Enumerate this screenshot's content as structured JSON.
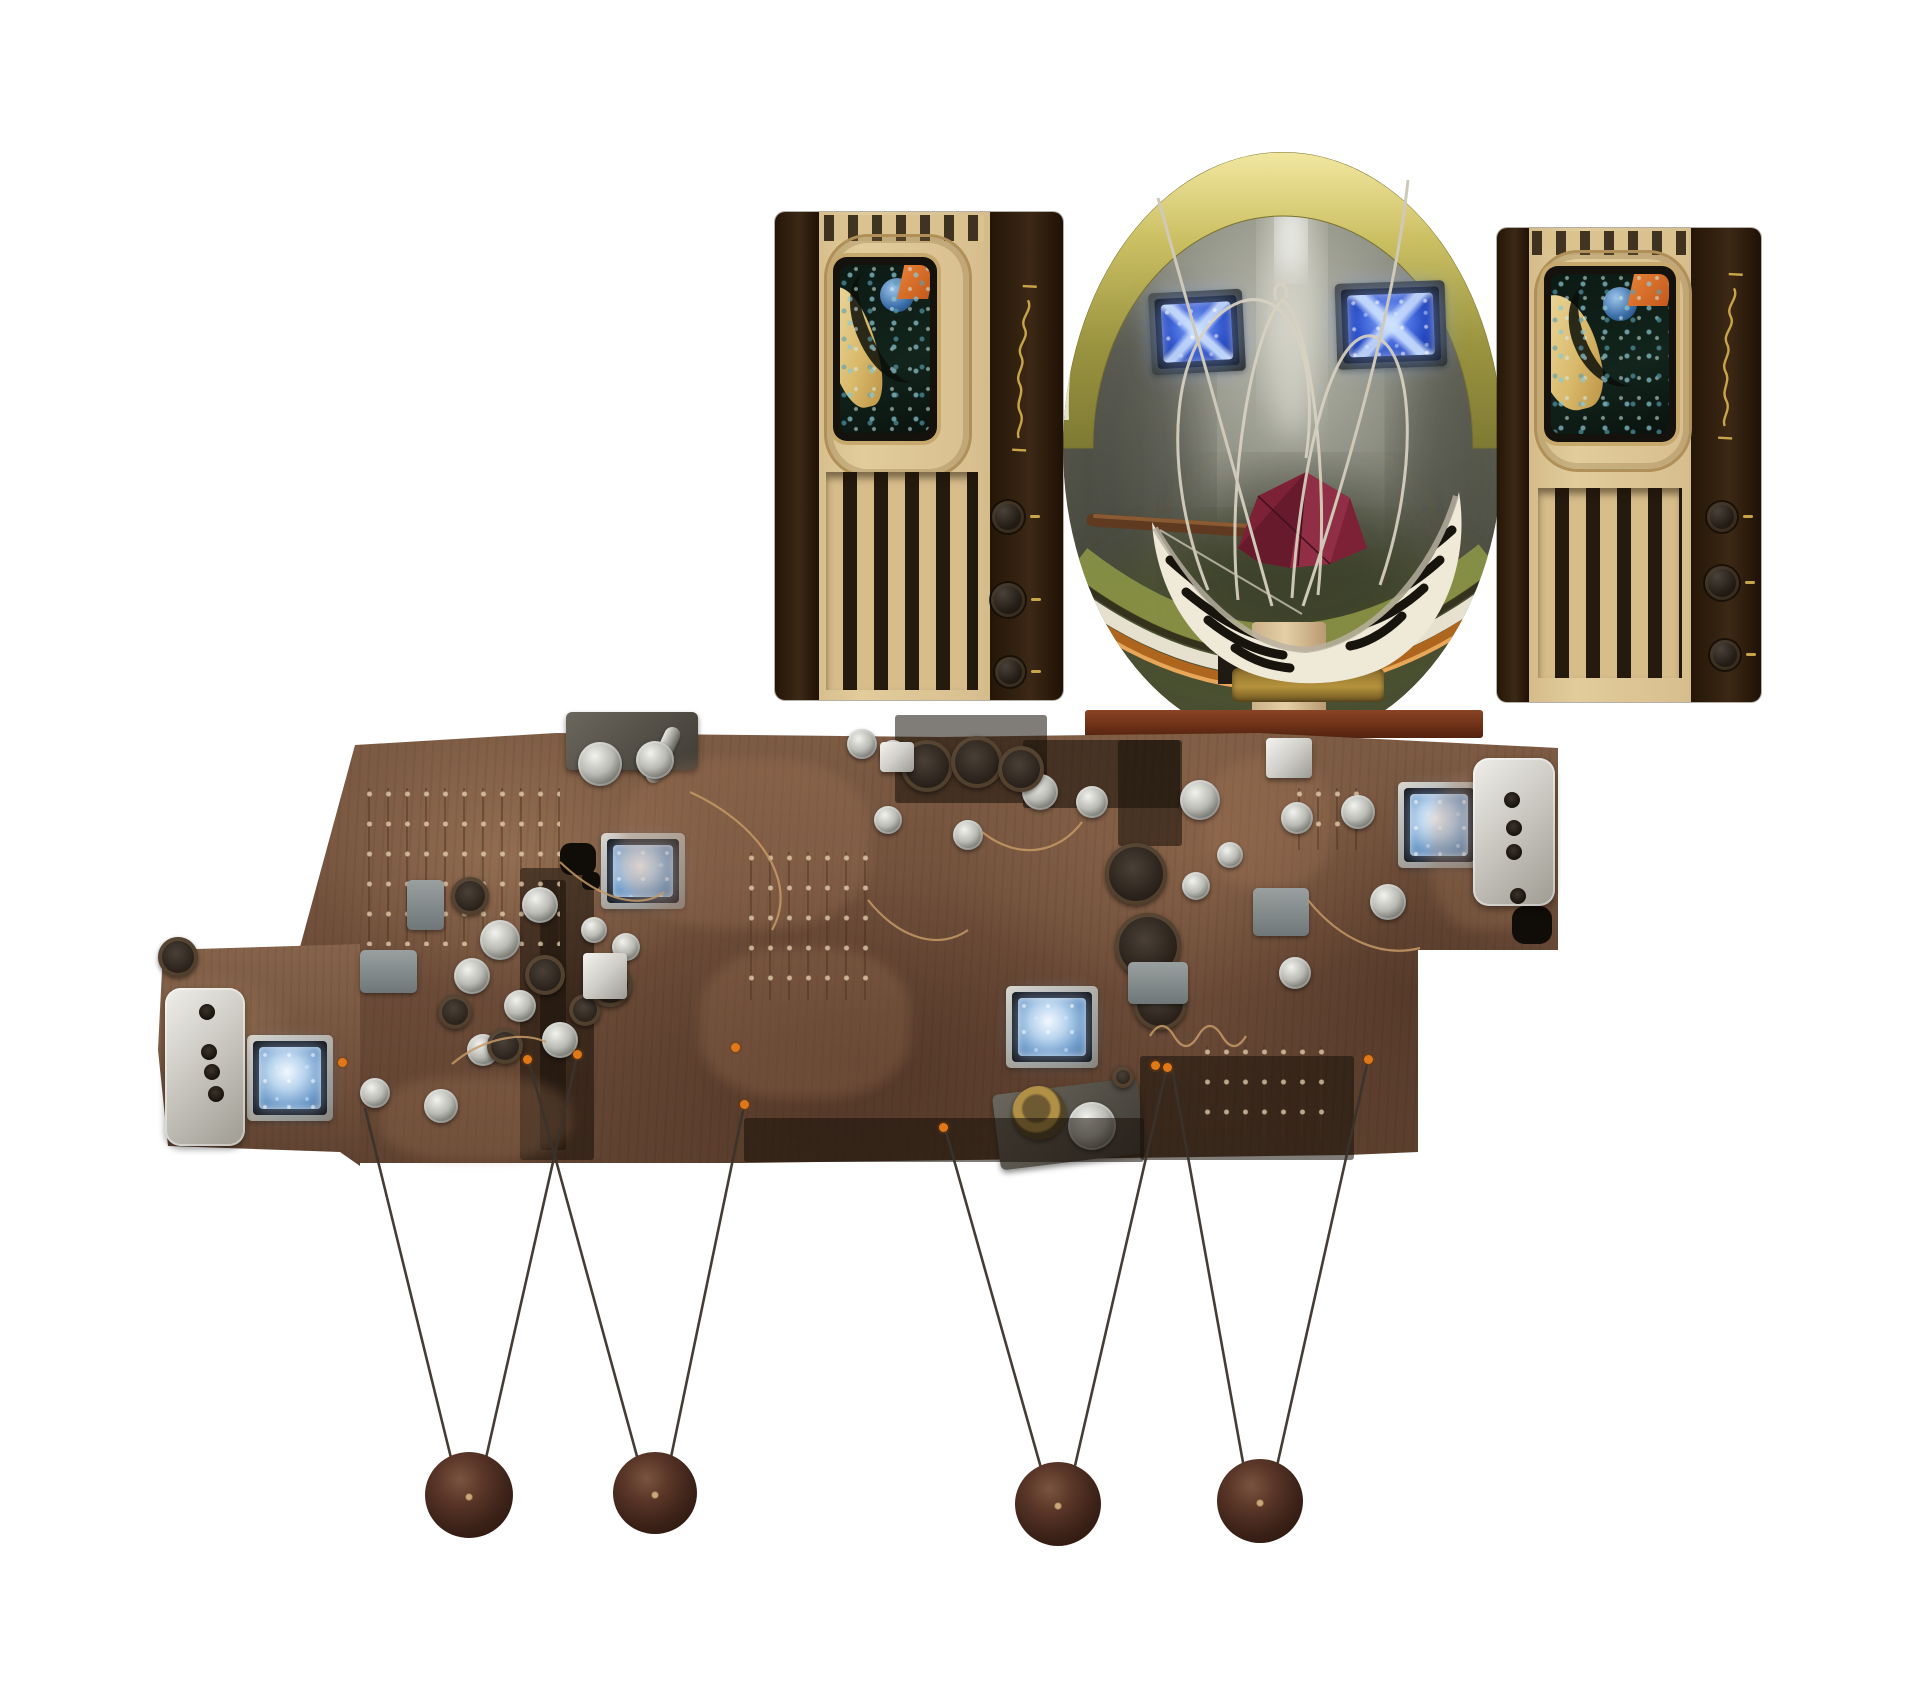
{
  "scene": {
    "title": "Photo collage of a vintage television video-art installation",
    "background": "#ffffff",
    "elements": [
      "two art-deco wooden televisions with small colorful CRT screens, vertical slats and side knobs",
      "large round metallic dish display with golden rim, two glowing blue mini screens, wire loops, a black-and-white striped bowl holding a dark red folded ornament on a pedestal and wooden base plank",
      "wide brown vintage circuit board panel with vacuum tubes, silver boxes and four glowing mini screens",
      "four thin wires hanging in V shapes from the board, each pair holding a dark wooden ball"
    ]
  },
  "palette": {
    "background": "#ffffff",
    "wood_board": "#6b4b38",
    "tv_cabinet_cream": "#d8bf8f",
    "tv_panel_dark": "#2e1d10",
    "dish_rim_gold": "#cbbf63",
    "dish_interior_grey": "#6b6d60",
    "glow_blue": "#4a6fe0",
    "bowl_white": "#efe9d8",
    "ornament_maroon": "#7c2136",
    "copper_band": "#b4671f",
    "anchor_orange": "#e07818",
    "ball_brown": "#3c2218",
    "script_gold": "#c9a54a"
  },
  "dish": {
    "screens": [
      {
        "x": 1150,
        "y": 291,
        "w": 94,
        "h": 82,
        "tilt": -3,
        "framed": false,
        "tone": "blue",
        "z": 2
      },
      {
        "x": 1336,
        "y": 282,
        "w": 110,
        "h": 86,
        "tilt": -2,
        "framed": false,
        "tone": "blue",
        "z": 2
      }
    ],
    "bowl_stripes_per_side": 4,
    "wire_loops": 3
  },
  "tvs": {
    "count": 2,
    "knobs": [
      [
        1008,
        517,
        16
      ],
      [
        1008,
        600,
        17
      ],
      [
        1010,
        672,
        15
      ],
      [
        1722,
        517,
        15
      ],
      [
        1722,
        583,
        17
      ],
      [
        1725,
        655,
        15
      ]
    ],
    "slats_per_tv": 5
  },
  "board": {
    "mini_screens": [
      {
        "x": 247,
        "y": 1035,
        "w": 86,
        "h": 86,
        "framed": true,
        "tone": "pale",
        "z": 4
      },
      {
        "x": 601,
        "y": 833,
        "w": 84,
        "h": 76,
        "framed": true,
        "tone": "pale",
        "z": 4
      },
      {
        "x": 1006,
        "y": 986,
        "w": 92,
        "h": 82,
        "framed": true,
        "tone": "pale",
        "z": 4
      },
      {
        "x": 1398,
        "y": 782,
        "w": 82,
        "h": 86,
        "framed": true,
        "tone": "pale",
        "z": 4
      }
    ],
    "silver_boxes": [
      {
        "x": 165,
        "y": 988,
        "w": 80,
        "h": 158,
        "holes": [
          [
            207,
            1012
          ],
          [
            209,
            1052
          ],
          [
            212,
            1072
          ],
          [
            216,
            1094
          ]
        ]
      },
      {
        "x": 1473,
        "y": 758,
        "w": 82,
        "h": 148,
        "holes": [
          [
            1512,
            800
          ],
          [
            1514,
            828
          ],
          [
            1514,
            852
          ],
          [
            1518,
            896
          ]
        ]
      }
    ],
    "tubes_silver": [
      [
        375,
        1093,
        15
      ],
      [
        441,
        1106,
        17
      ],
      [
        600,
        764,
        22
      ],
      [
        655,
        760,
        19
      ],
      [
        540,
        905,
        18
      ],
      [
        500,
        940,
        20
      ],
      [
        472,
        976,
        18
      ],
      [
        520,
        1006,
        16
      ],
      [
        560,
        1040,
        18
      ],
      [
        483,
        1050,
        16
      ],
      [
        594,
        930,
        13
      ],
      [
        626,
        947,
        14
      ],
      [
        888,
        820,
        14
      ],
      [
        862,
        744,
        15
      ],
      [
        893,
        753,
        13
      ],
      [
        968,
        835,
        15
      ],
      [
        1040,
        792,
        18
      ],
      [
        1092,
        802,
        16
      ],
      [
        1200,
        800,
        20
      ],
      [
        1297,
        818,
        16
      ],
      [
        1196,
        886,
        14
      ],
      [
        1295,
        973,
        16
      ],
      [
        1358,
        812,
        17
      ],
      [
        1388,
        902,
        18
      ],
      [
        1230,
        855,
        13
      ]
    ],
    "tubes_dark": [
      [
        927,
        766,
        26
      ],
      [
        977,
        762,
        26
      ],
      [
        1021,
        769,
        23
      ],
      [
        1136,
        874,
        31
      ],
      [
        1148,
        946,
        33
      ],
      [
        1160,
        1003,
        27
      ],
      [
        470,
        896,
        19
      ],
      [
        455,
        1012,
        17
      ],
      [
        505,
        1046,
        18
      ],
      [
        585,
        1010,
        16
      ],
      [
        545,
        975,
        20
      ],
      [
        610,
        985,
        22
      ],
      [
        178,
        957,
        20
      ]
    ],
    "cubes": [
      [
        583,
        953,
        44,
        46
      ],
      [
        1266,
        738,
        46,
        40
      ],
      [
        880,
        742,
        34,
        30
      ]
    ],
    "grey_blocks": [
      [
        407,
        880,
        37,
        50
      ],
      [
        360,
        950,
        57,
        43
      ],
      [
        1253,
        888,
        56,
        48
      ],
      [
        1128,
        962,
        60,
        42
      ]
    ],
    "black_squares": [
      [
        560,
        843,
        36,
        32
      ],
      [
        582,
        872,
        18,
        18
      ],
      [
        1512,
        906,
        40,
        38
      ]
    ],
    "pin_zones": [
      [
        360,
        788,
        200,
        158
      ],
      [
        742,
        852,
        128,
        148
      ],
      [
        1290,
        788,
        70,
        62
      ],
      [
        1198,
        1046,
        138,
        92
      ]
    ],
    "dark_zones": [
      [
        1023,
        740,
        157,
        68
      ],
      [
        1118,
        740,
        64,
        106
      ],
      [
        520,
        868,
        74,
        292
      ],
      [
        540,
        880,
        26,
        270
      ],
      [
        895,
        715,
        152,
        88
      ],
      [
        1140,
        1056,
        214,
        104
      ],
      [
        744,
        1118,
        400,
        44
      ]
    ],
    "light_zones": [
      [
        620,
        758,
        250,
        170
      ],
      [
        700,
        948,
        210,
        150
      ],
      [
        1205,
        758,
        125,
        130
      ],
      [
        380,
        1076,
        190,
        84
      ],
      [
        1430,
        770,
        120,
        160
      ]
    ],
    "anchor_dots": [
      [
        342,
        1062
      ],
      [
        527,
        1059
      ],
      [
        577,
        1054
      ],
      [
        735,
        1047
      ],
      [
        744,
        1104
      ],
      [
        943,
        1127
      ],
      [
        1155,
        1065
      ],
      [
        1167,
        1067
      ],
      [
        1368,
        1059
      ]
    ]
  },
  "pendulums": {
    "wires": [
      [
        365,
        1108,
        452,
        1462
      ],
      [
        577,
        1056,
        486,
        1458
      ],
      [
        528,
        1058,
        638,
        1460
      ],
      [
        744,
        1106,
        670,
        1462
      ],
      [
        945,
        1128,
        1041,
        1468
      ],
      [
        1167,
        1067,
        1074,
        1470
      ],
      [
        1172,
        1068,
        1244,
        1468
      ],
      [
        1368,
        1060,
        1277,
        1466
      ]
    ],
    "balls": [
      {
        "cx": 469,
        "cy": 1496,
        "r": 44
      },
      {
        "cx": 655,
        "cy": 1494,
        "r": 42
      },
      {
        "cx": 1058,
        "cy": 1505,
        "r": 43
      },
      {
        "cx": 1260,
        "cy": 1502,
        "r": 43
      }
    ]
  }
}
